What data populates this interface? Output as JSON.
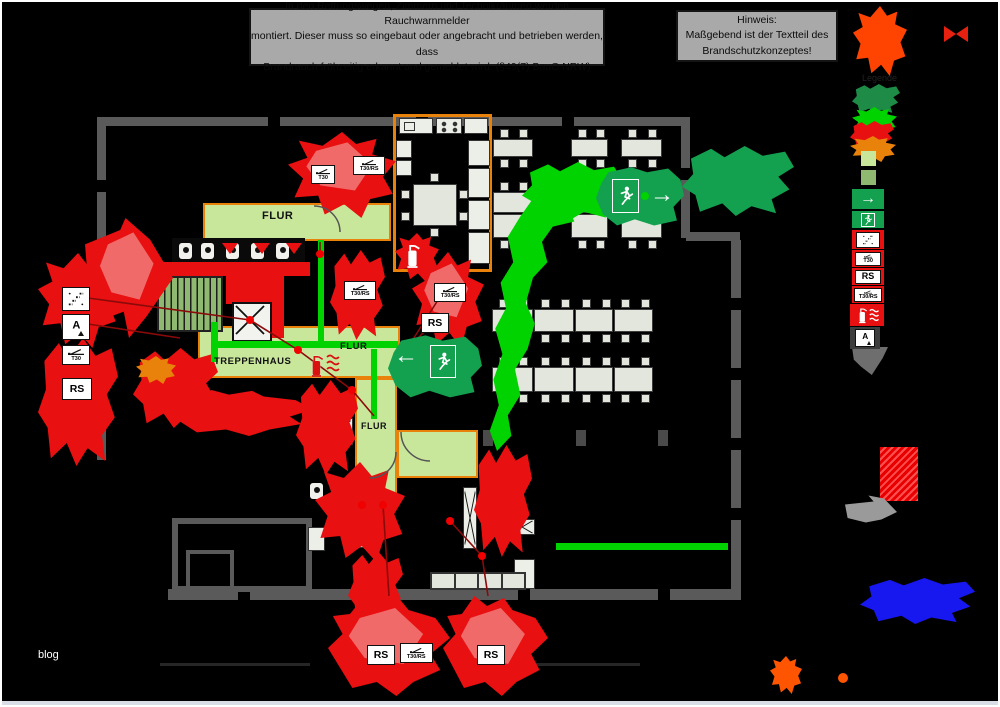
{
  "notice": {
    "lines": [
      "In den Rettungswegen, Zimmern und Technikräumen werden Rauchwarnmelder",
      "montiert. Dieser muss so eingebaut oder angebracht und betrieben werden, dass",
      "Brandrauch frühzeitig erkannt und gemeldet wird. (§49(7) BauO NRW)"
    ]
  },
  "hinweis": {
    "lines": [
      "Hinweis:",
      "Maßgebend ist der Textteil des",
      "Brandschutzkonzeptes!"
    ]
  },
  "legend": {
    "title": "Legende"
  },
  "labels": {
    "flur": "FLUR",
    "treppenhaus": "TREPPENHAUS"
  },
  "tags": {
    "t30": "T30",
    "rs": "RS",
    "t30rs": "T30/RS",
    "a": "A"
  },
  "icons": {
    "arrow_right": "→",
    "arrow_left": "←"
  },
  "watermark": "blog",
  "colors": {
    "fire_red": "#e81010",
    "escape_green": "#00d300",
    "exit_green": "#13a04f",
    "corridor_green": "#c9e79b",
    "sage_green": "#8fb870",
    "accent_orange": "#e8820a",
    "wall_gray": "#5a5a5a",
    "panel_gray": "#a9a9a9",
    "desk_fill": "#e2e6dc",
    "deep_blue": "#1717f0",
    "legend_orange": "#ff4300"
  }
}
